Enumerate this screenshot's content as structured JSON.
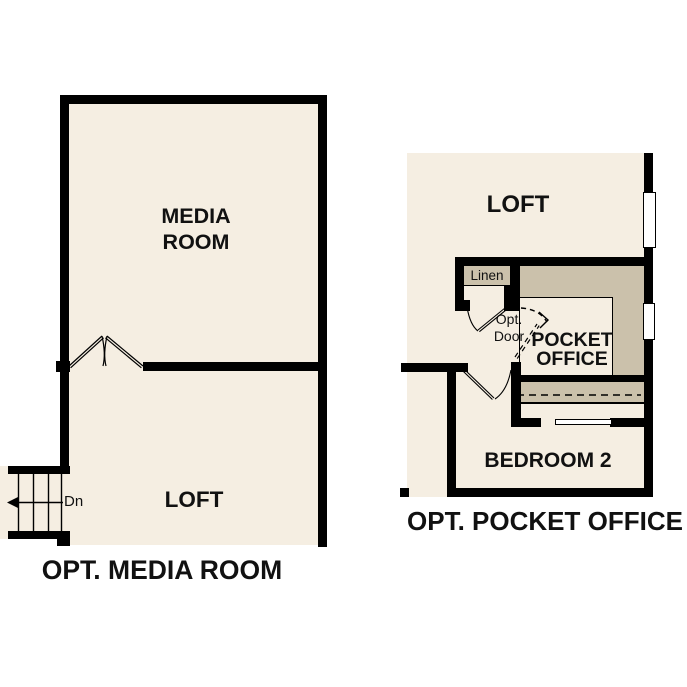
{
  "colors": {
    "background": "#ffffff",
    "room_fill": "#f5eee2",
    "shaded_fill": "#cbc1ab",
    "wall": "#000000",
    "label_text": "#111111"
  },
  "left_plan": {
    "media_room_label": "MEDIA ROOM",
    "loft_label": "LOFT",
    "stairs_direction_label": "Dn",
    "caption": "OPT. MEDIA ROOM"
  },
  "right_plan": {
    "loft_label": "LOFT",
    "linen_label": "Linen",
    "opt_door_label": "Opt. Door",
    "pocket_office_label": "POCKET OFFICE",
    "bedroom_label": "BEDROOM 2",
    "caption": "OPT. POCKET OFFICE"
  }
}
